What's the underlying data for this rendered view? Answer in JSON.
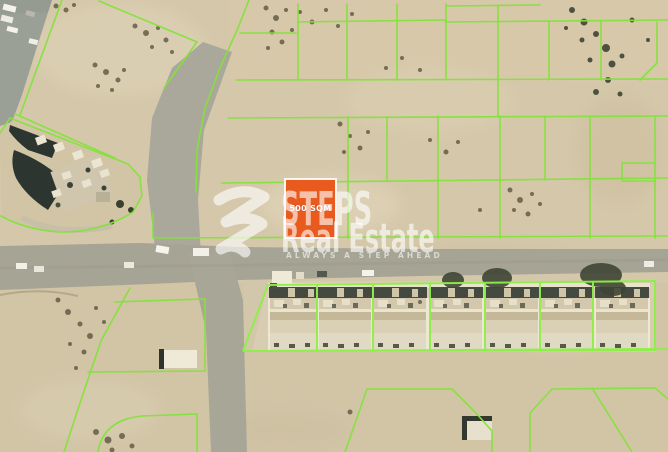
{
  "map": {
    "description": "Satellite aerial view of desert land parcels outlined in green, with roads, a construction site, a row of seven villas and a highlighted plot for sale",
    "sand_color": "#D5C8AA",
    "road_color": "#A6A494",
    "parcel_line_color": "#84E23C",
    "villa_count": "7"
  },
  "plot": {
    "area_label": "500 SQM",
    "fill_color": "#E85A1E",
    "border_color": "#FFFFFF"
  },
  "watermark": {
    "logo": "steps-logo-s",
    "brand_line1": "STEPS",
    "brand_line2": "Real Estate",
    "tagline": "ALWAYS A STEP AHEAD",
    "text_color": "#FFFFFF"
  }
}
